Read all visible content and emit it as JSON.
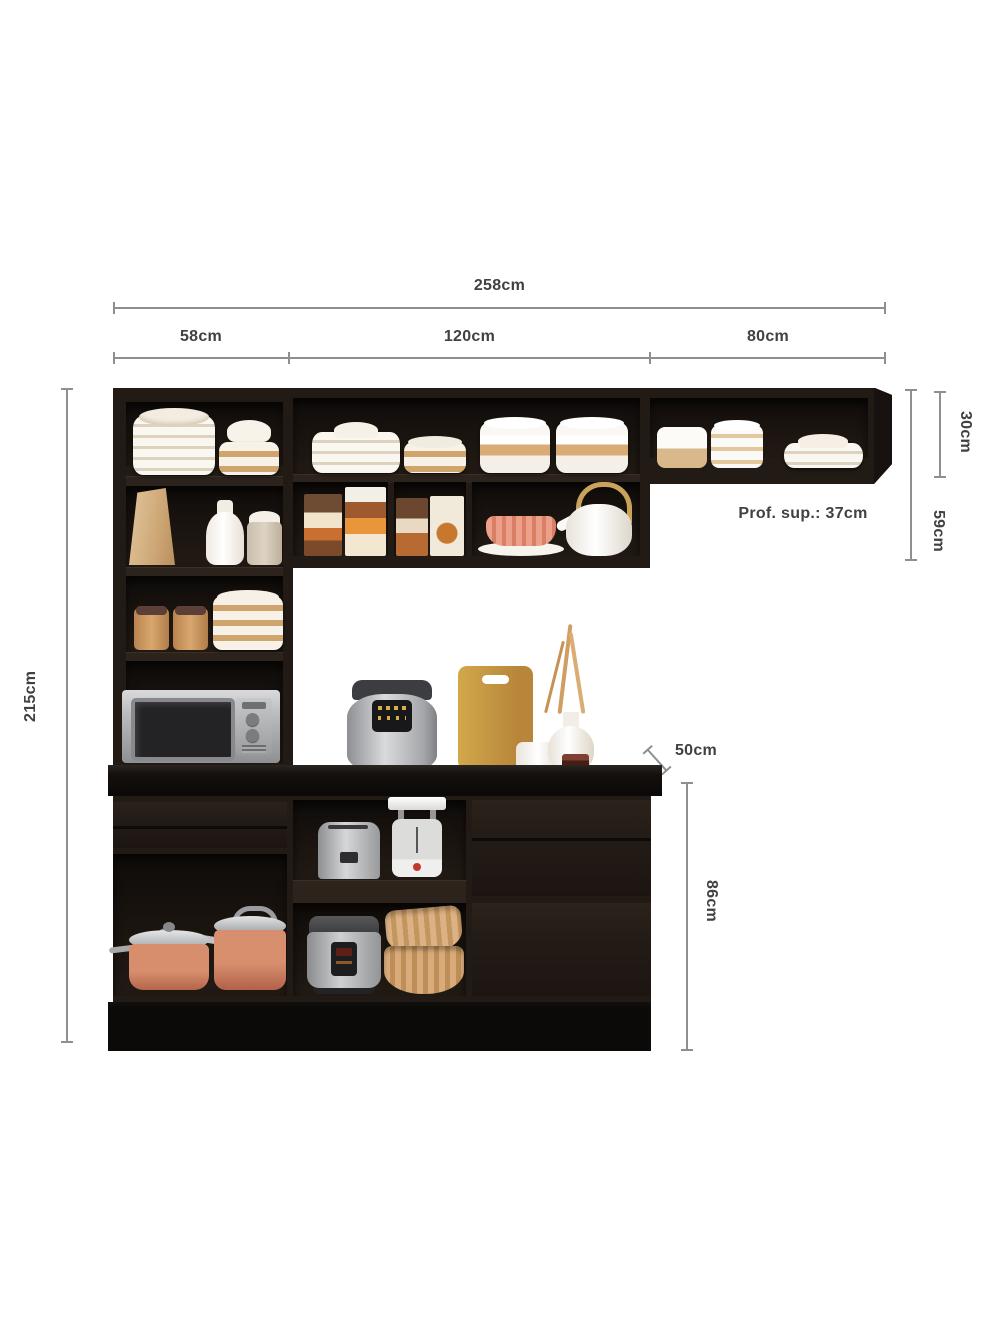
{
  "labels": {
    "total_width": "258cm",
    "section_left_width": "58cm",
    "section_middle_width": "120cm",
    "section_right_width": "80cm",
    "total_height": "215cm",
    "upper_right_shelf_height": "30cm",
    "upper_cabinet_height": "59cm",
    "upper_shelf_depth": "Prof. sup.: 37cm",
    "countertop_depth": "50cm",
    "base_cabinet_height": "86cm"
  },
  "colors": {
    "background": "#ffffff",
    "cabinet_body": "#211a15",
    "cabinet_interior": "#18120e",
    "plinth": "#0c0a08",
    "dimension_line": "#8f8f8f",
    "dimension_text": "#414141",
    "copper": "#bf7050",
    "wood": "#c79d45",
    "silver": "#b9babc",
    "cream": "#f6f1e8"
  }
}
